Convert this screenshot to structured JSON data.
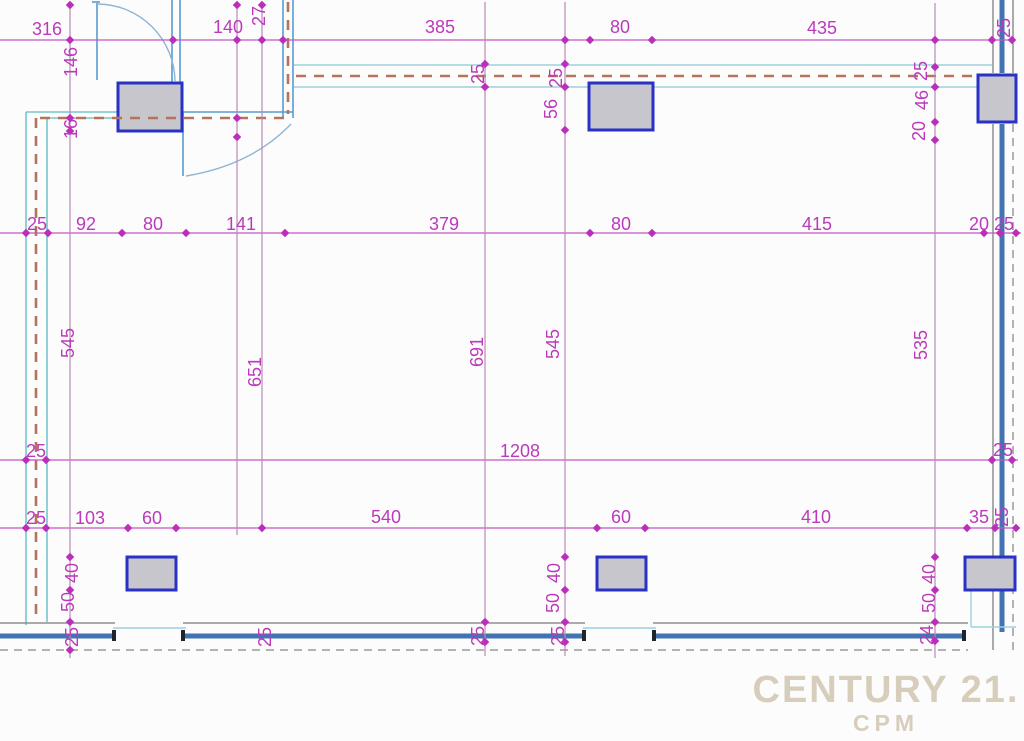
{
  "watermark": {
    "brand": "CENTURY 21.",
    "sub": "CPM"
  },
  "colors": {
    "dim_text": "#bb3abb",
    "dim_line_h": "#c653c6",
    "dim_line_v": "#b88ab8",
    "tick": "#bb2dbb",
    "wall_cyan": "#9dd2da",
    "wall_teal": "#74c6cb",
    "wall_blue": "#569bd0",
    "wall_core_blue": "#4273b2",
    "wall_gray": "#8e8e8e",
    "dash_brown": "#b5735c",
    "column_border": "#2a31c5",
    "column_fill": "#c6c6cc",
    "watermark": "#d7cdbb"
  },
  "dim_labels": [
    {
      "t": "316",
      "x": 47,
      "y": 29,
      "r": 0
    },
    {
      "t": "140",
      "x": 228,
      "y": 27,
      "r": 0
    },
    {
      "t": "27",
      "x": 259,
      "y": 16,
      "r": 90
    },
    {
      "t": "385",
      "x": 440,
      "y": 27,
      "r": 0
    },
    {
      "t": "80",
      "x": 620,
      "y": 27,
      "r": 0
    },
    {
      "t": "435",
      "x": 822,
      "y": 28,
      "r": 0
    },
    {
      "t": "25",
      "x": 1004,
      "y": 28,
      "r": 90
    },
    {
      "t": "25",
      "x": 37,
      "y": 224,
      "r": 0
    },
    {
      "t": "92",
      "x": 86,
      "y": 224,
      "r": 0
    },
    {
      "t": "80",
      "x": 153,
      "y": 224,
      "r": 0
    },
    {
      "t": "141",
      "x": 241,
      "y": 224,
      "r": 0
    },
    {
      "t": "379",
      "x": 444,
      "y": 224,
      "r": 0
    },
    {
      "t": "80",
      "x": 621,
      "y": 224,
      "r": 0
    },
    {
      "t": "415",
      "x": 817,
      "y": 224,
      "r": 0
    },
    {
      "t": "20",
      "x": 979,
      "y": 224,
      "r": 0
    },
    {
      "t": "25",
      "x": 1004,
      "y": 224,
      "r": 0
    },
    {
      "t": "25",
      "x": 36,
      "y": 451,
      "r": 0
    },
    {
      "t": "1208",
      "x": 520,
      "y": 451,
      "r": 0
    },
    {
      "t": "25",
      "x": 1003,
      "y": 450,
      "r": 0
    },
    {
      "t": "25",
      "x": 36,
      "y": 518,
      "r": 0
    },
    {
      "t": "103",
      "x": 90,
      "y": 518,
      "r": 0
    },
    {
      "t": "60",
      "x": 152,
      "y": 518,
      "r": 0
    },
    {
      "t": "540",
      "x": 386,
      "y": 517,
      "r": 0
    },
    {
      "t": "60",
      "x": 621,
      "y": 517,
      "r": 0
    },
    {
      "t": "410",
      "x": 816,
      "y": 517,
      "r": 0
    },
    {
      "t": "35",
      "x": 979,
      "y": 517,
      "r": 0
    },
    {
      "t": "25",
      "x": 1002,
      "y": 517,
      "r": 90
    },
    {
      "t": "146",
      "x": 71,
      "y": 62,
      "r": 90
    },
    {
      "t": "16",
      "x": 71,
      "y": 129,
      "r": 90
    },
    {
      "t": "545",
      "x": 68,
      "y": 343,
      "r": 90
    },
    {
      "t": "40",
      "x": 72,
      "y": 573,
      "r": 90
    },
    {
      "t": "50",
      "x": 68,
      "y": 602,
      "r": 90
    },
    {
      "t": "25",
      "x": 72,
      "y": 637,
      "r": 90
    },
    {
      "t": "651",
      "x": 255,
      "y": 372,
      "r": 90
    },
    {
      "t": "25",
      "x": 265,
      "y": 637,
      "r": 90
    },
    {
      "t": "25",
      "x": 478,
      "y": 74,
      "r": 90
    },
    {
      "t": "691",
      "x": 477,
      "y": 352,
      "r": 90
    },
    {
      "t": "25",
      "x": 478,
      "y": 636,
      "r": 90
    },
    {
      "t": "25",
      "x": 556,
      "y": 78,
      "r": 90
    },
    {
      "t": "56",
      "x": 551,
      "y": 109,
      "r": 90
    },
    {
      "t": "545",
      "x": 553,
      "y": 344,
      "r": 90
    },
    {
      "t": "40",
      "x": 554,
      "y": 573,
      "r": 90
    },
    {
      "t": "50",
      "x": 553,
      "y": 603,
      "r": 90
    },
    {
      "t": "25",
      "x": 558,
      "y": 636,
      "r": 90
    },
    {
      "t": "25",
      "x": 921,
      "y": 71,
      "r": 90
    },
    {
      "t": "46",
      "x": 922,
      "y": 100,
      "r": 90
    },
    {
      "t": "20",
      "x": 919,
      "y": 131,
      "r": 90
    },
    {
      "t": "535",
      "x": 921,
      "y": 345,
      "r": 90
    },
    {
      "t": "40",
      "x": 929,
      "y": 574,
      "r": 90
    },
    {
      "t": "50",
      "x": 929,
      "y": 603,
      "r": 90
    },
    {
      "t": "24",
      "x": 927,
      "y": 635,
      "r": 90
    }
  ],
  "dim_lines": {
    "horizontal": [
      {
        "y": 40,
        "x1": 0,
        "x2": 1013
      },
      {
        "y": 233,
        "x1": 0,
        "x2": 1021
      },
      {
        "y": 460,
        "x1": 0,
        "x2": 1018
      },
      {
        "y": 528,
        "x1": 0,
        "x2": 1019
      }
    ],
    "vertical": [
      {
        "x": 70,
        "y1": 5,
        "y2": 658
      },
      {
        "x": 237,
        "y1": 5,
        "y2": 535
      },
      {
        "x": 262,
        "y1": 5,
        "y2": 532
      },
      {
        "x": 485,
        "y1": 2,
        "y2": 656
      },
      {
        "x": 565,
        "y1": 2,
        "y2": 656
      },
      {
        "x": 935,
        "y1": 3,
        "y2": 658
      }
    ]
  },
  "ticks": [
    [
      70,
      40
    ],
    [
      173,
      40
    ],
    [
      237,
      40
    ],
    [
      262,
      40
    ],
    [
      283,
      40
    ],
    [
      565,
      40
    ],
    [
      590,
      40
    ],
    [
      652,
      40
    ],
    [
      935,
      40
    ],
    [
      992,
      40
    ],
    [
      1012,
      40
    ],
    [
      26,
      233
    ],
    [
      48,
      233
    ],
    [
      122,
      233
    ],
    [
      186,
      233
    ],
    [
      285,
      233
    ],
    [
      590,
      233
    ],
    [
      652,
      233
    ],
    [
      984,
      233
    ],
    [
      1000,
      233
    ],
    [
      1016,
      233
    ],
    [
      26,
      460
    ],
    [
      46,
      460
    ],
    [
      992,
      460
    ],
    [
      1012,
      460
    ],
    [
      26,
      528
    ],
    [
      46,
      528
    ],
    [
      128,
      528
    ],
    [
      176,
      528
    ],
    [
      262,
      528
    ],
    [
      597,
      528
    ],
    [
      645,
      528
    ],
    [
      967,
      528
    ],
    [
      995,
      528
    ],
    [
      1016,
      528
    ],
    [
      70,
      5
    ],
    [
      70,
      118
    ],
    [
      70,
      131
    ],
    [
      70,
      557
    ],
    [
      70,
      590
    ],
    [
      70,
      622
    ],
    [
      70,
      650
    ],
    [
      237,
      5
    ],
    [
      237,
      118
    ],
    [
      237,
      137
    ],
    [
      262,
      5
    ],
    [
      485,
      64
    ],
    [
      485,
      87
    ],
    [
      485,
      622
    ],
    [
      485,
      642
    ],
    [
      565,
      64
    ],
    [
      565,
      87
    ],
    [
      565,
      130
    ],
    [
      565,
      557
    ],
    [
      565,
      590
    ],
    [
      565,
      622
    ],
    [
      565,
      642
    ],
    [
      935,
      67
    ],
    [
      935,
      87
    ],
    [
      935,
      122
    ],
    [
      935,
      140
    ],
    [
      935,
      557
    ],
    [
      935,
      590
    ],
    [
      935,
      622
    ],
    [
      935,
      641
    ]
  ]
}
